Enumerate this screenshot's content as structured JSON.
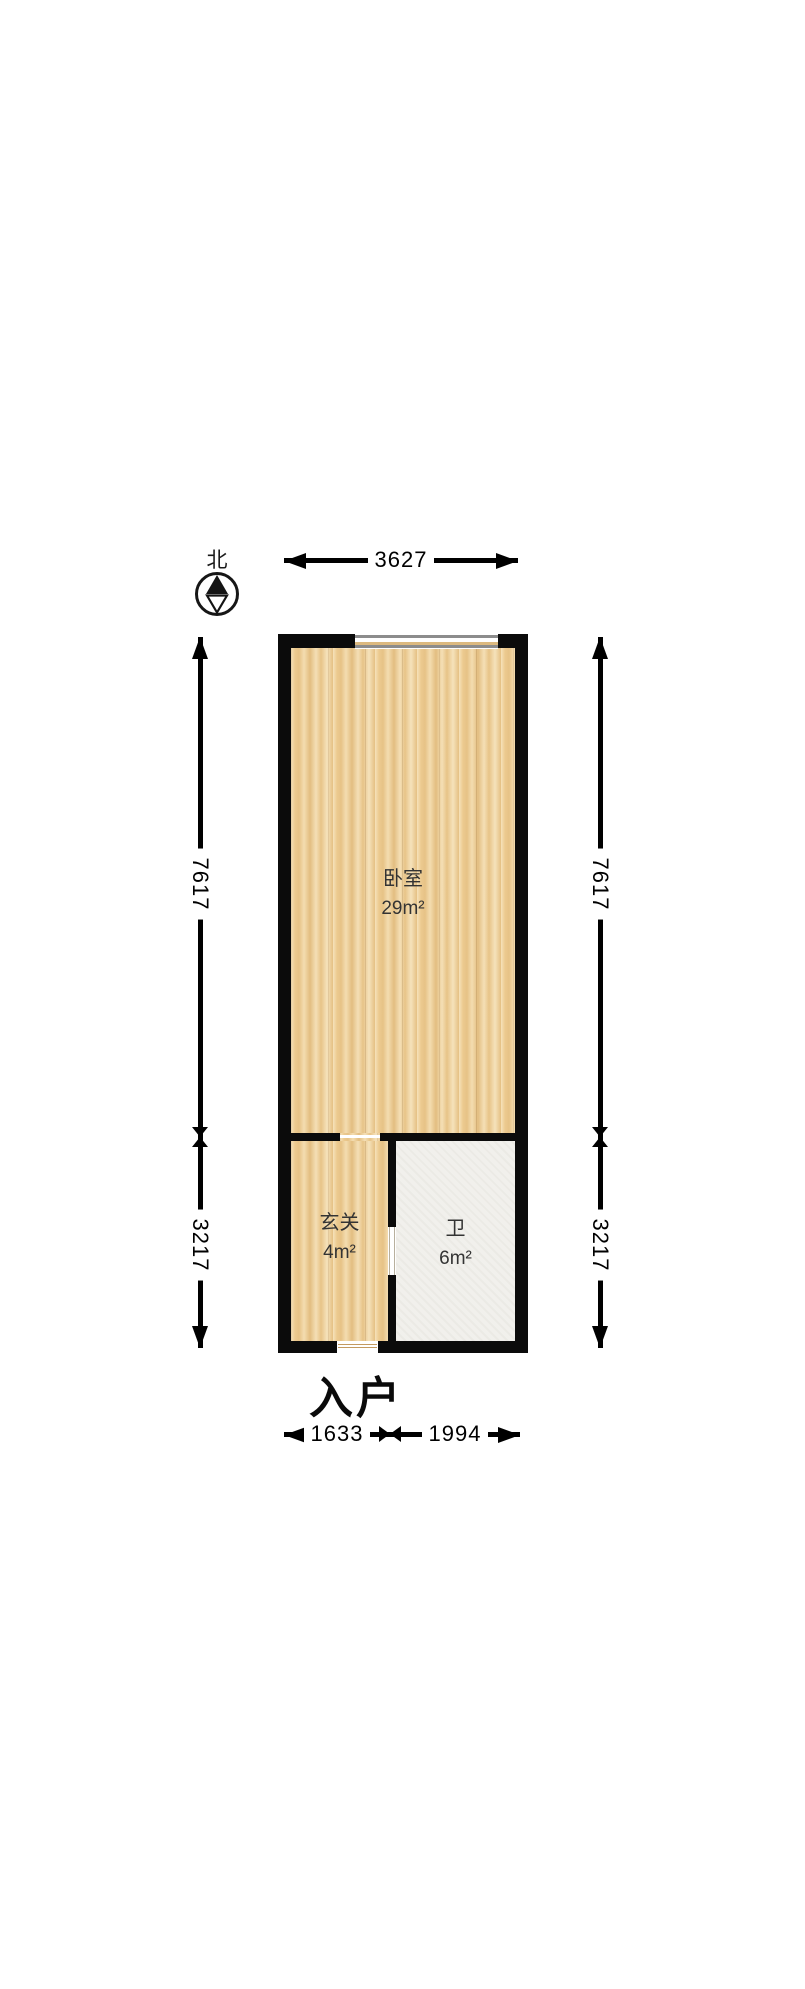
{
  "compass": {
    "label": "北"
  },
  "dimensions": {
    "top": {
      "value": "3627"
    },
    "left": {
      "upper": "7617",
      "lower": "3217"
    },
    "right": {
      "upper": "7617",
      "lower": "3217"
    },
    "bottom": {
      "left": "1633",
      "right": "1994"
    }
  },
  "rooms": [
    {
      "name": "卧室",
      "area": "29m²",
      "floor": "wood"
    },
    {
      "name": "玄关",
      "area": "4m²",
      "floor": "wood"
    },
    {
      "name": "卫",
      "area": "6m²",
      "floor": "tile"
    }
  ],
  "entrance": {
    "label": "入户"
  },
  "colors": {
    "wall": "#0b0b0b",
    "wood_floor": "#ecca8f",
    "tile_floor": "#f1f0ec",
    "window_frame": "#8c8c8c",
    "threshold": "#c39a60",
    "dimension_line": "#000000",
    "room_text": "#333333"
  }
}
